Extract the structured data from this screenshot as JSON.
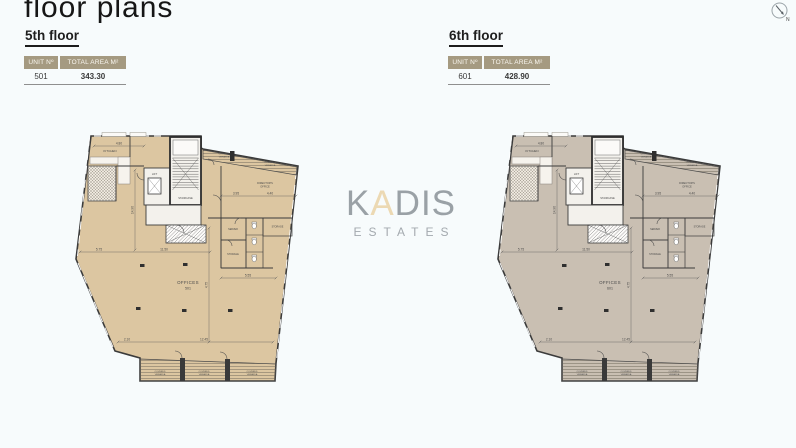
{
  "page": {
    "title": "floor plans"
  },
  "north": {
    "label": "N"
  },
  "watermark": {
    "k": "K",
    "a": "A",
    "dis": "DIS",
    "subtitle": "ESTATES"
  },
  "plan_labels": {
    "kitchen": "KITCHEN",
    "lift": "LIFT",
    "staircase": "STAIRCASE",
    "covered": "COVERED",
    "veranda": "VERANDA",
    "directors": "DIRECTOR'S",
    "office": "OFFICE",
    "server": "SERVER",
    "storage": "STORAGE",
    "offices": "OFFICES"
  },
  "dimensions": [
    "4.80",
    "3.95",
    "4.40",
    "5.75",
    "11.50",
    "4.75",
    "5.55",
    "2.10",
    "12.45",
    "14.90"
  ],
  "floors": [
    {
      "heading": "5th floor",
      "table": {
        "header_unit": "UNIT Nº",
        "header_area": "TOTAL AREA M²",
        "unit": "501",
        "area": "343.30"
      },
      "plan": {
        "fill": "#dcc6a1",
        "unit_number": "501"
      }
    },
    {
      "heading": "6th floor",
      "table": {
        "header_unit": "UNIT Nº",
        "header_area": "TOTAL AREA M²",
        "unit": "601",
        "area": "428.90"
      },
      "plan": {
        "fill": "#c9bfb2",
        "unit_number": "601"
      }
    }
  ]
}
